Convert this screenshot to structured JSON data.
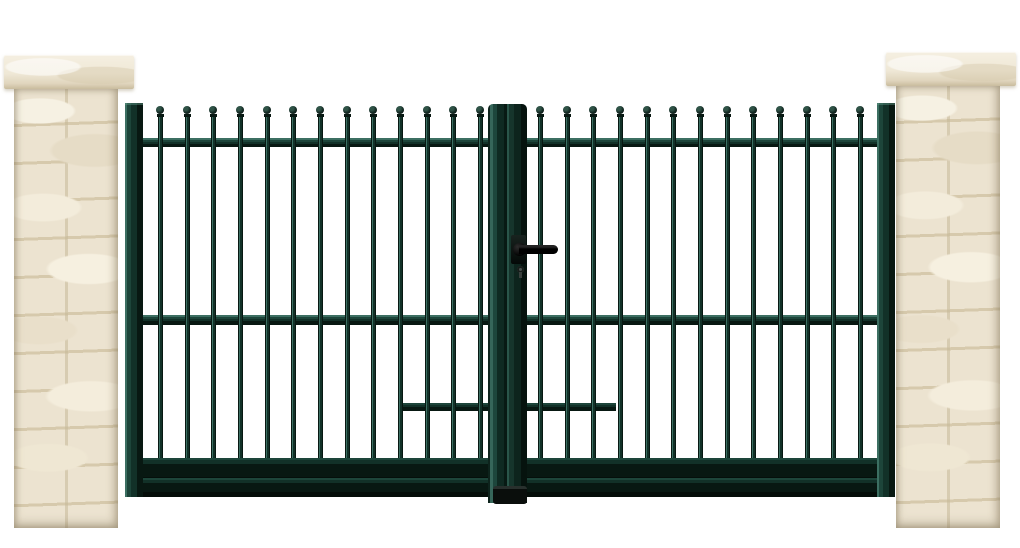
{
  "scene": {
    "type": "product-photograph",
    "subject": "double-leaf swing gate with ball finials between two stone pillars",
    "background_color": "#ffffff"
  },
  "pillars": {
    "colors": {
      "stone": "#ece3d0",
      "mortar": "#d6c9ac",
      "cap": "#f5efe1"
    },
    "count": 2,
    "left": {
      "cap": {
        "x": 4,
        "y": 55,
        "w": 130,
        "h": 34
      },
      "body": {
        "x": 14,
        "y": 89,
        "w": 104,
        "h": 439
      }
    },
    "right": {
      "cap": {
        "x": 886,
        "y": 52,
        "w": 130,
        "h": 34
      },
      "body": {
        "x": 896,
        "y": 86,
        "w": 104,
        "h": 442
      }
    }
  },
  "gate": {
    "colors": {
      "base": "#123128",
      "mid": "#1d453a",
      "dark": "#081812",
      "highlight": "#3c6f62",
      "handle": "#0a0a0a"
    },
    "leaf_count": 2,
    "bar_count_per_leaf": 13,
    "finial_style": "ball",
    "bars": {
      "width": 5,
      "ball_diameter": 8,
      "ball_top_y": 106,
      "stem_bottom_y": 458,
      "left_leaf_centers": [
        160,
        187,
        213,
        240,
        267,
        293,
        320,
        347,
        373,
        400,
        427,
        453,
        480
      ],
      "right_leaf_centers": [
        540,
        567,
        593,
        620,
        647,
        673,
        700,
        727,
        753,
        780,
        807,
        833,
        860
      ]
    },
    "rails": {
      "top": {
        "y": 138,
        "h": 9
      },
      "middle": {
        "y": 315,
        "h": 10
      },
      "bottom": {
        "y": 458,
        "h": 39
      },
      "lock_rail_left": {
        "x": 399,
        "y": 403,
        "w": 89,
        "h": 8
      },
      "lock_rail_right": {
        "x": 527,
        "y": 403,
        "w": 89,
        "h": 8
      }
    },
    "center_post": {
      "x": 488,
      "y": 104,
      "w": 39,
      "h": 399
    },
    "stop_block": {
      "x": 493,
      "y": 486,
      "w": 34,
      "h": 18
    },
    "hardware": {
      "handle": "lever-handle",
      "lock": "keyhole-cylinder"
    }
  }
}
